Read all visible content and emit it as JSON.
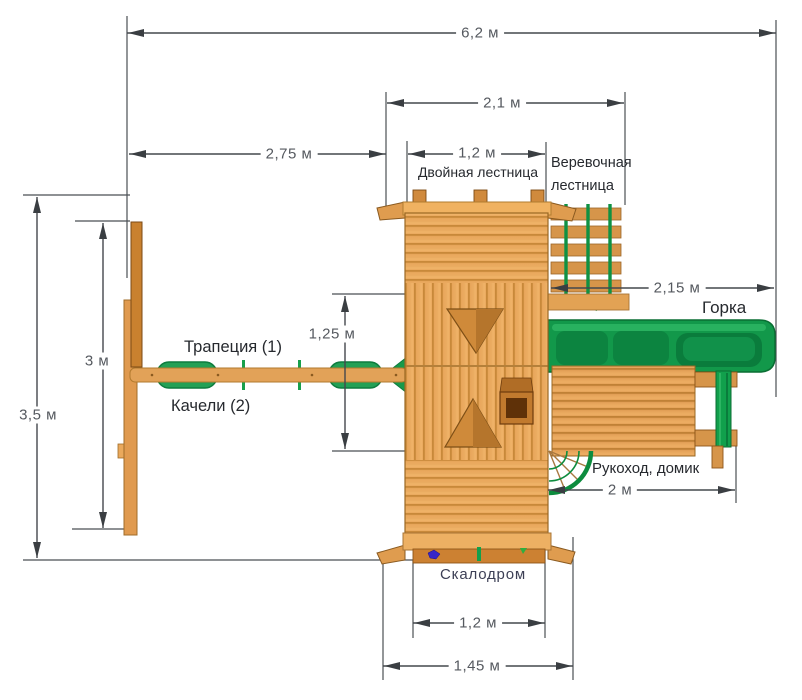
{
  "dimensions": {
    "total_width": "6,2 м",
    "top_section_width": "2,1 м",
    "swing_span": "2,75 м",
    "double_ladder_width": "1,2 м",
    "platform_depth": "1,25 м",
    "frame_height": "3 м",
    "total_depth": "3,5 м",
    "slide_length": "2,15 м",
    "house_length": "2 м",
    "climbing_wall_width": "1,2 м",
    "base_width": "1,45 м"
  },
  "labels": {
    "double_ladder": "Двойная лестница",
    "rope_ladder": "Веревочная лестница",
    "slide": "Горка",
    "trapeze": "Трапеция (1)",
    "swings": "Качели (2)",
    "monkey_bars_house": "Рукоход, домик",
    "climbing_wall": "Скалодром"
  },
  "colors": {
    "wood_light": "#e9a75c",
    "wood_medium": "#d6954a",
    "wood_dark_hole": "#5f3108",
    "green": "#12984a",
    "green_dark": "#0a6e33",
    "dimension_line": "#44484d",
    "dimension_text": "#55595f",
    "label_text": "#26292e",
    "climbing_hold_blue": "#3626c9"
  }
}
